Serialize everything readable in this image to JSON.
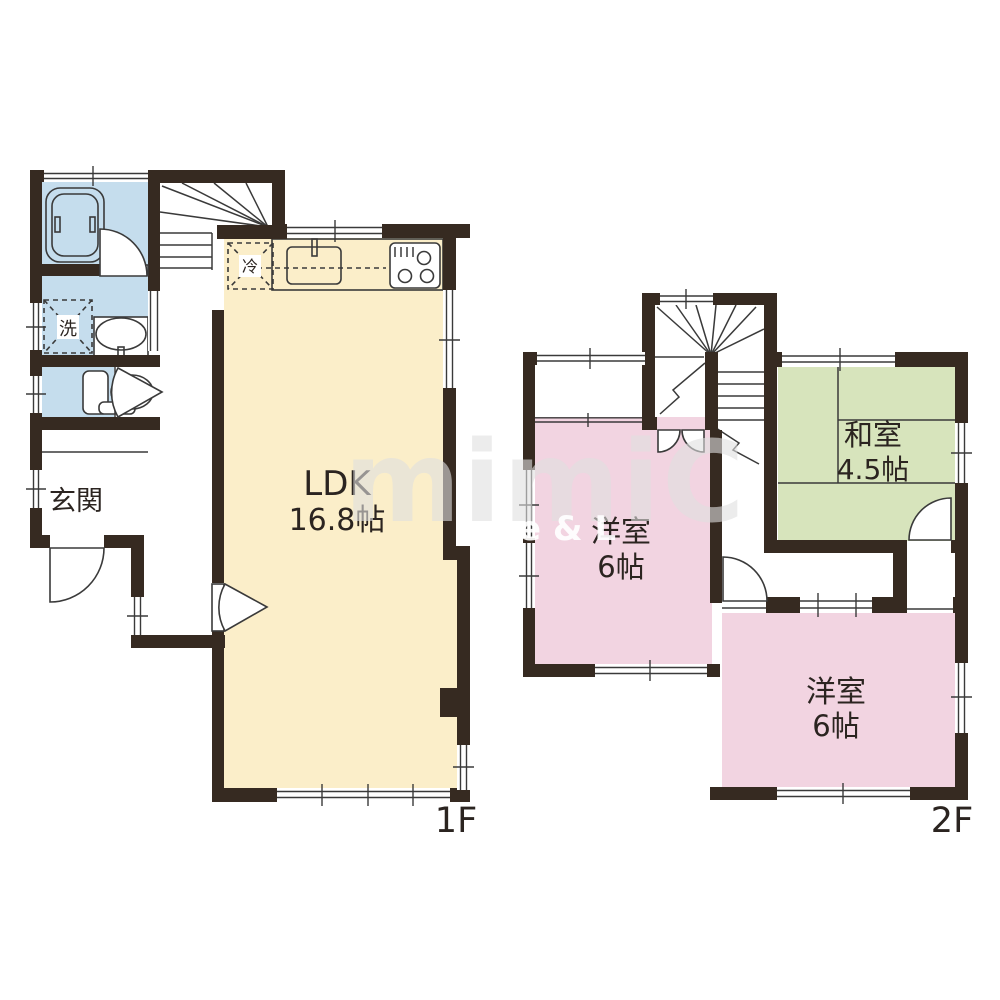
{
  "floor1": {
    "label": "1F",
    "ldk_name": "LDK",
    "ldk_size": "16.8帖",
    "genkan": "玄関",
    "washer": "洗",
    "fridge": "冷"
  },
  "floor2": {
    "label": "2F",
    "room1_name": "洋室",
    "room1_size": "6帖",
    "washitsu_name": "和室",
    "washitsu_size": "4.5帖",
    "room2_name": "洋室",
    "room2_size": "6帖"
  },
  "watermark": {
    "main": "mimiC",
    "sub": "e & L"
  },
  "colors": {
    "wall": "#362a21",
    "ldk_floor": "#fbeec9",
    "wet_floor": "#c5dded",
    "western_floor": "#f2d4e1",
    "tatami_floor": "#d7e4bc",
    "label": "#2b2420"
  }
}
